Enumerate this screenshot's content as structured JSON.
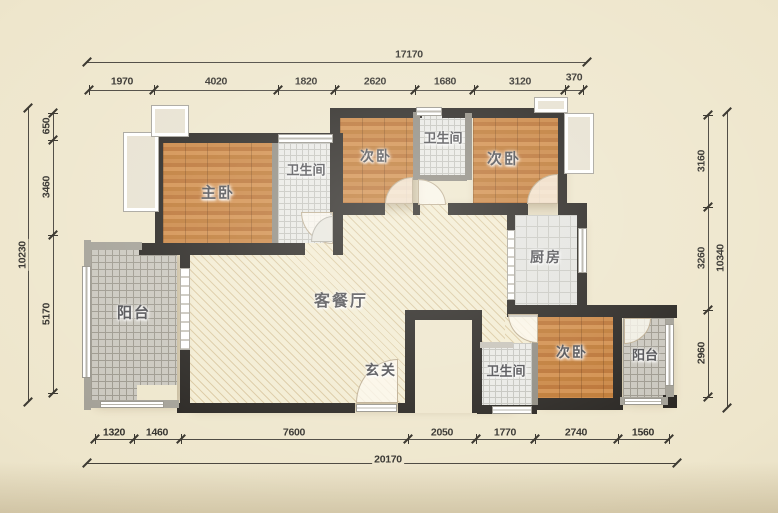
{
  "floorplan": {
    "rooms": {
      "master_bedroom": "主卧",
      "bathroom_top_left": "卫生间",
      "bedroom_top_middle": "次卧",
      "bathroom_top_middle": "卫生间",
      "bedroom_top_right": "次卧",
      "kitchen": "厨房",
      "living_dining": "客餐厅",
      "entry": "玄关",
      "bathroom_bottom": "卫生间",
      "bedroom_bottom_right": "次卧",
      "balcony_left": "阳台",
      "balcony_right": "阳台"
    },
    "dimensions": {
      "top": {
        "total": "17170",
        "segments": [
          "1970",
          "4020",
          "1820",
          "2620",
          "1680",
          "3120",
          "370"
        ]
      },
      "bottom": {
        "total": "20170",
        "segments": [
          "1320",
          "1460",
          "7600",
          "2050",
          "1770",
          "2740",
          "1560"
        ]
      },
      "left": {
        "total": "10230",
        "segments": [
          "650",
          "3460",
          "5170"
        ]
      },
      "right": {
        "total": "10340",
        "segments": [
          "3160",
          "3260",
          "2960"
        ]
      }
    },
    "colors": {
      "background": "#eee6cc",
      "wall": "#23201c",
      "wood_floor": "#c9833f",
      "bathroom_tile": "#e9e9e5",
      "balcony_tile": "#c9c6bd",
      "living_floor": "#f3ecd2",
      "dimension_text": "#2f2d28"
    }
  }
}
